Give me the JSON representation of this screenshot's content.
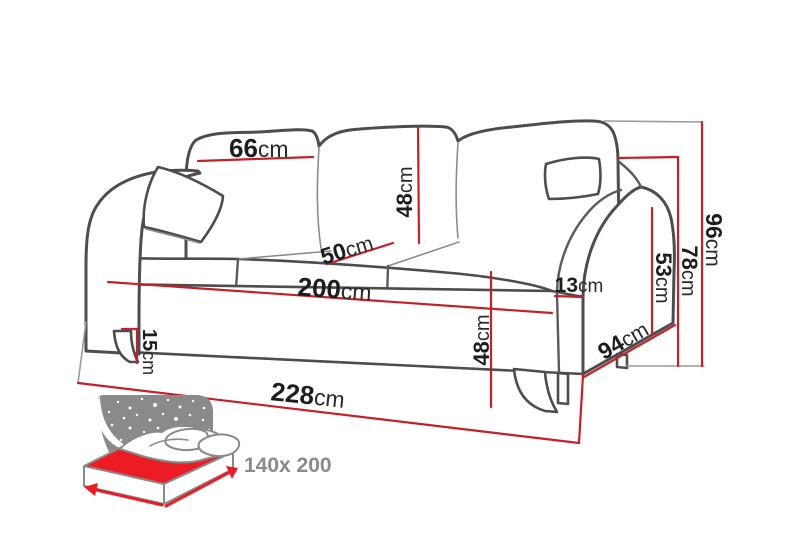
{
  "diagram": {
    "title": "sofa-bed dimension diagram",
    "unit": "cm",
    "colors": {
      "dimension_red": "#c32028",
      "outline_gray": "#4d4d4d",
      "icon_gray": "#8a8a8a",
      "bed_red": "#eb1c24",
      "label_black": "#1d1d1d"
    },
    "dimensions": {
      "back_cushion_width": {
        "value": "66",
        "unit": "cm"
      },
      "back_cushion_height": {
        "value": "48",
        "unit": "cm"
      },
      "seat_depth": {
        "value": "50",
        "unit": "cm"
      },
      "seat_width": {
        "value": "200",
        "unit": "cm"
      },
      "armrest_width": {
        "value": "13",
        "unit": "cm"
      },
      "seat_height": {
        "value": "48",
        "unit": "cm"
      },
      "leg_height": {
        "value": "15",
        "unit": "cm"
      },
      "total_width": {
        "value": "228",
        "unit": "cm"
      },
      "total_depth": {
        "value": "94",
        "unit": "cm"
      },
      "armrest_height": {
        "value": "53",
        "unit": "cm"
      },
      "back_height": {
        "value": "78",
        "unit": "cm"
      },
      "total_height": {
        "value": "96",
        "unit": "cm"
      }
    },
    "bed_function": {
      "size_label": "140x 200"
    }
  }
}
